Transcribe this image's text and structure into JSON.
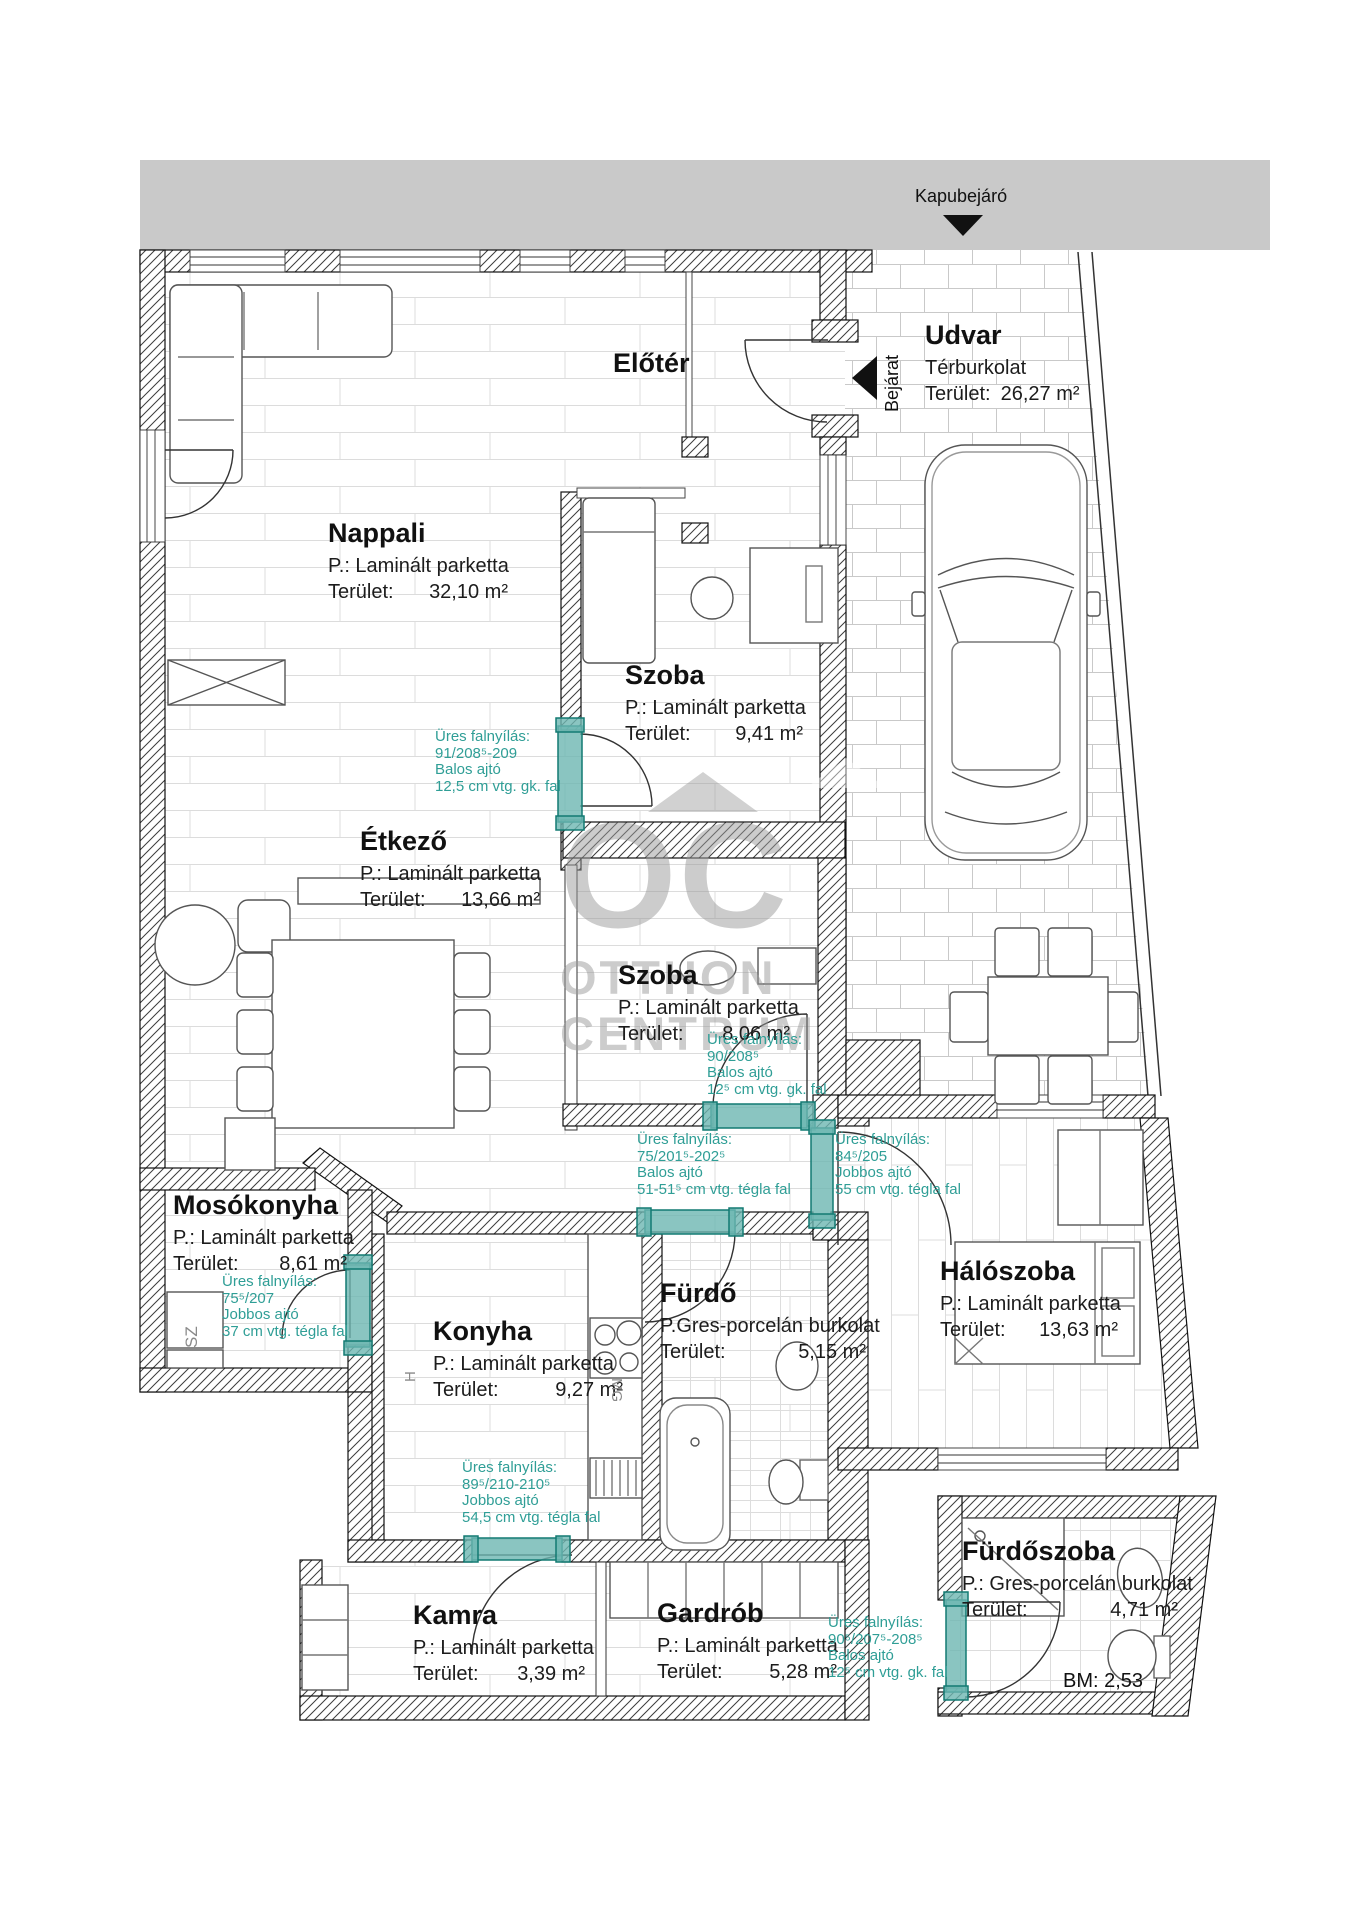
{
  "header": {
    "gate_label": "Kapubejáró",
    "entrance_label": "Bejárat"
  },
  "watermark": [
    "OC",
    "OTTHON",
    "CENTRUM"
  ],
  "rooms": {
    "udvar": {
      "name": "Udvar",
      "floor": "Térburkolat",
      "area_label": "Terület:",
      "area": "26,27 m²"
    },
    "eloter": {
      "name": "Előtér"
    },
    "nappali": {
      "name": "Nappali",
      "floor": "P.: Laminált parketta",
      "area_label": "Terület:",
      "area": "32,10 m²"
    },
    "szoba1": {
      "name": "Szoba",
      "floor": "P.: Laminált parketta",
      "area_label": "Terület:",
      "area": "9,41 m²"
    },
    "etkezo": {
      "name": "Étkező",
      "floor": "P.: Laminált parketta",
      "area_label": "Terület:",
      "area": "13,66 m²"
    },
    "szoba2": {
      "name": "Szoba",
      "floor": "P.: Laminált parketta",
      "area_label": "Terület:",
      "area": "8,06 m²"
    },
    "mosokonyha": {
      "name": "Mosókonyha",
      "floor": "P.: Laminált parketta",
      "area_label": "Terület:",
      "area": "8,61 m²"
    },
    "konyha": {
      "name": "Konyha",
      "floor": "P.: Laminált parketta",
      "area_label": "Terület:",
      "area": "9,27 m²"
    },
    "furdo": {
      "name": "Fürdő",
      "floor": "P.Gres-porcelán burkolat",
      "area_label": "Terület:",
      "area": "5,15 m²"
    },
    "haloszoba": {
      "name": "Hálószoba",
      "floor": "P.: Laminált parketta",
      "area_label": "Terület:",
      "area": "13,63 m²"
    },
    "kamra": {
      "name": "Kamra",
      "floor": "P.: Laminált parketta",
      "area_label": "Terület:",
      "area": "3,39 m²"
    },
    "gardrob": {
      "name": "Gardrób",
      "floor": "P.: Laminált parketta",
      "area_label": "Terület:",
      "area": "5,28 m²"
    },
    "furdoszoba": {
      "name": "Fürdőszoba",
      "floor": "P.: Gres-porcelán burkolat",
      "area_label": "Terület:",
      "area": "4,71 m²"
    }
  },
  "annotations": {
    "a1": [
      "Üres falnyílás:",
      "91/208⁵-209",
      "Balos ajtó",
      "12,5 cm vtg. gk. fal"
    ],
    "a2": [
      "Üres falnyílás:",
      "90/208⁵",
      "Balos ajtó",
      "12⁵ cm vtg. gk. fal"
    ],
    "a3": [
      "Üres falnyílás:",
      "75/201⁵-202⁵",
      "Balos ajtó",
      "51-51⁵ cm vtg. tégla fal"
    ],
    "a4": [
      "Üres falnyílás:",
      "84⁵/205",
      "Jobbos ajtó",
      "55 cm vtg. tégla fal"
    ],
    "a5": [
      "Üres falnyílás:",
      "75⁵/207",
      "Jobbos ajtó",
      "37 cm vtg. tégla fal"
    ],
    "a6": [
      "Üres falnyílás:",
      "89⁵/210-210⁵",
      "Jobbos ajtó",
      "54,5 cm vtg. tégla fal"
    ],
    "a7": [
      "Üres falnyílás:",
      "90⁵/207⁵-208⁵",
      "Balos ajtó",
      "12⁵ cm vtg. gk. fal"
    ]
  },
  "misc": {
    "bm": "BM: 2,53",
    "sz": "SZ",
    "h": "H",
    "mg": "MG"
  },
  "colors": {
    "teal_text": "#2f9e96",
    "teal_fill": "#6db7b1",
    "teal_stroke": "#127a72",
    "gray_band": "#c9c9c9",
    "watermark": "#9a9a9a"
  }
}
